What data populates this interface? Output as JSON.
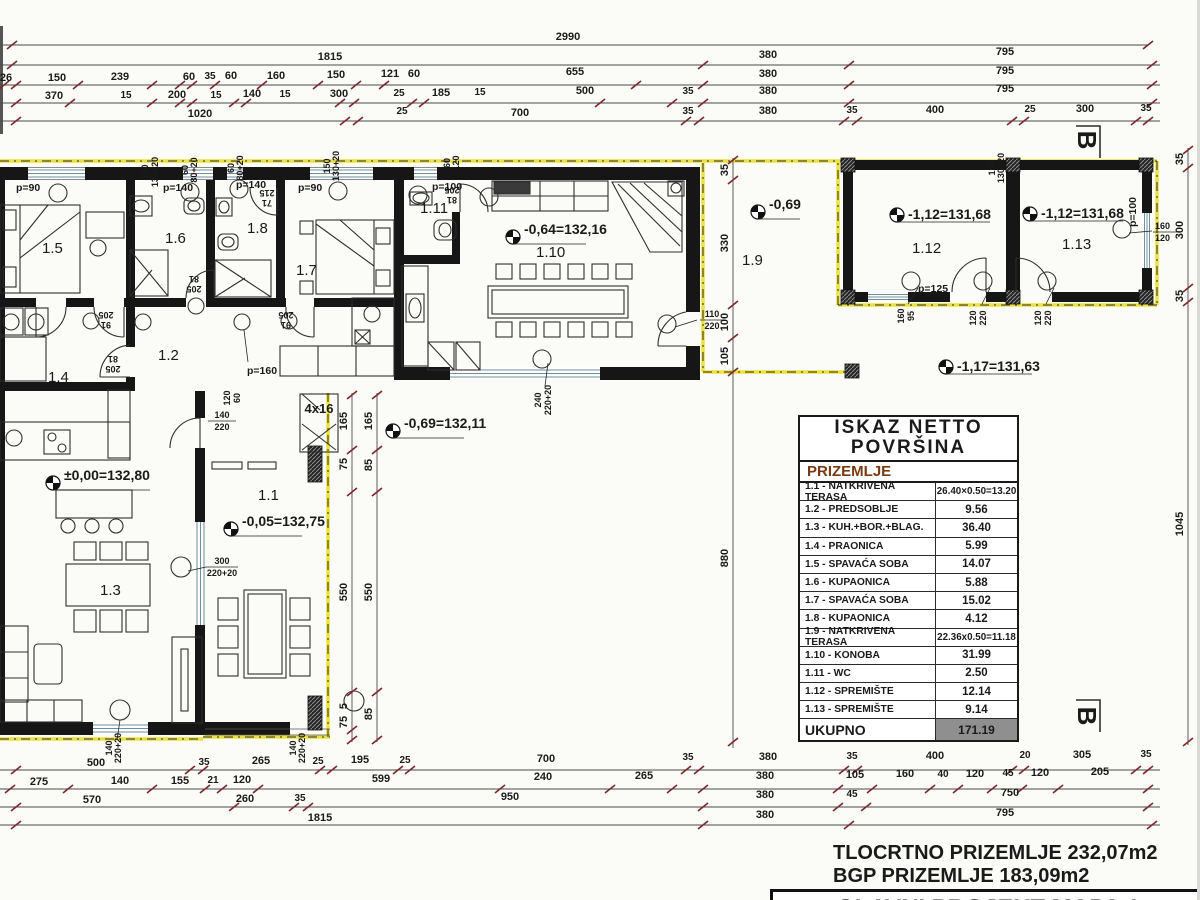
{
  "table": {
    "title": "ISKAZ NETTO POVRŠINA",
    "floor": "PRIZEMLJE",
    "rows": [
      {
        "label": "1.1 - NATKRIVENA TERASA",
        "value": "26.40×0.50=13.20"
      },
      {
        "label": "1.2 - PREDSOBLJE",
        "value": "9.56"
      },
      {
        "label": "1.3 - KUH.+BOR.+BLAG.",
        "value": "36.40"
      },
      {
        "label": "1.4 - PRAONICA",
        "value": "5.99"
      },
      {
        "label": "1.5 - SPAVAĆA SOBA",
        "value": "14.07"
      },
      {
        "label": "1.6 - KUPAONICA",
        "value": "5.88"
      },
      {
        "label": "1.7 - SPAVAĆA SOBA",
        "value": "15.02"
      },
      {
        "label": "1.8 - KUPAONICA",
        "value": "4.12"
      },
      {
        "label": "1.9 - NATKRIVENA TERASA",
        "value": "22.36x0.50=11.18"
      },
      {
        "label": "1.10 - KONOBA",
        "value": "31.99"
      },
      {
        "label": "1.11 - WC",
        "value": "2.50"
      },
      {
        "label": "1.12 - SPREMIŠTE",
        "value": "12.14"
      },
      {
        "label": "1.13 - SPREMIŠTE",
        "value": "9.14"
      }
    ],
    "total_label": "UKUPNO",
    "total_value": "171.19"
  },
  "footer": {
    "line1": "TLOCRTNO PRIZEMLJE 232,07m2",
    "line2": "BGP PRIZEMLJE 183,09m2",
    "titleblock": "GLAVNI PROJEKT MAPA 1"
  },
  "section": {
    "label": "B"
  },
  "rooms": {
    "r1_1": "1.1",
    "r1_2": "1.2",
    "r1_3": "1.3",
    "r1_4": "1.4",
    "r1_5": "1.5",
    "r1_6": "1.6",
    "r1_7": "1.7",
    "r1_8": "1.8",
    "r1_9": "1.9",
    "r1_10": "1.10",
    "r1_11": "1.11",
    "r1_12": "1.12",
    "r1_13": "1.13"
  },
  "elev": {
    "e000": "±0,00=132,80",
    "e005": "-0,05=132,75",
    "e069a": "-0,69=132,11",
    "e064": "-0,64=132,16",
    "e069b": "-0,69",
    "e112": "-1,12=131,68",
    "e117": "-1,17=131,63"
  },
  "dims": {
    "top": {
      "r1": [
        "2990"
      ],
      "r2": [
        "1815",
        "380",
        "795"
      ],
      "r3": [
        "26",
        "150",
        "239",
        "60",
        "35",
        "60",
        "160",
        "150",
        "121",
        "60",
        "655",
        "380",
        "795"
      ],
      "r4": [
        "370",
        "15",
        "200",
        "15",
        "140",
        "15",
        "300",
        "25",
        "185",
        "15",
        "500",
        "35",
        "380",
        "795"
      ],
      "r5": [
        "1020",
        "25",
        "700",
        "35",
        "380",
        "35",
        "400",
        "25",
        "300",
        "35"
      ]
    },
    "bottom": {
      "r1": [
        "500",
        "35",
        "265",
        "25",
        "195",
        "25",
        "700",
        "35",
        "380",
        "35",
        "400",
        "20",
        "305",
        "35"
      ],
      "r2": [
        "275",
        "140",
        "155",
        "21",
        "120",
        "599",
        "240",
        "265",
        "380",
        "105",
        "160",
        "40",
        "120",
        "45",
        "120",
        "205"
      ],
      "r3": [
        "570",
        "260",
        "35",
        "950",
        "380",
        "45",
        "750"
      ],
      "r4": [
        "1815",
        "380",
        "795"
      ]
    },
    "mid": [
      "35",
      "330",
      "100",
      "105",
      "880"
    ],
    "right": [
      "35",
      "300",
      "35",
      "1045"
    ],
    "stairL": [
      "165",
      "75",
      "550",
      "5",
      "75"
    ],
    "stairR": [
      "165",
      "85",
      "550",
      "85"
    ]
  },
  "gl": {
    "150": "150",
    "130+20": "130+20",
    "60": "60",
    "80+20": "80+20",
    "120": "120",
    "81": "81",
    "91": "91",
    "205": "205",
    "215": "215",
    "71": "71",
    "110": "110",
    "220": "220",
    "140": "140",
    "160": "160",
    "95": "95",
    "240": "240",
    "220+20": "220+20",
    "300": "300",
    "4x16": "4x16",
    "p=90": "p=90",
    "p=100": "p=100",
    "p=125": "p=125",
    "p=140": "p=140",
    "p=160": "p=160"
  },
  "colors": {
    "floor_header": "#7a3a10",
    "highlight_yellow": "#ece23e",
    "tick_red": "#7b2b2b",
    "total_cell_bg": "#8f8f8f"
  }
}
